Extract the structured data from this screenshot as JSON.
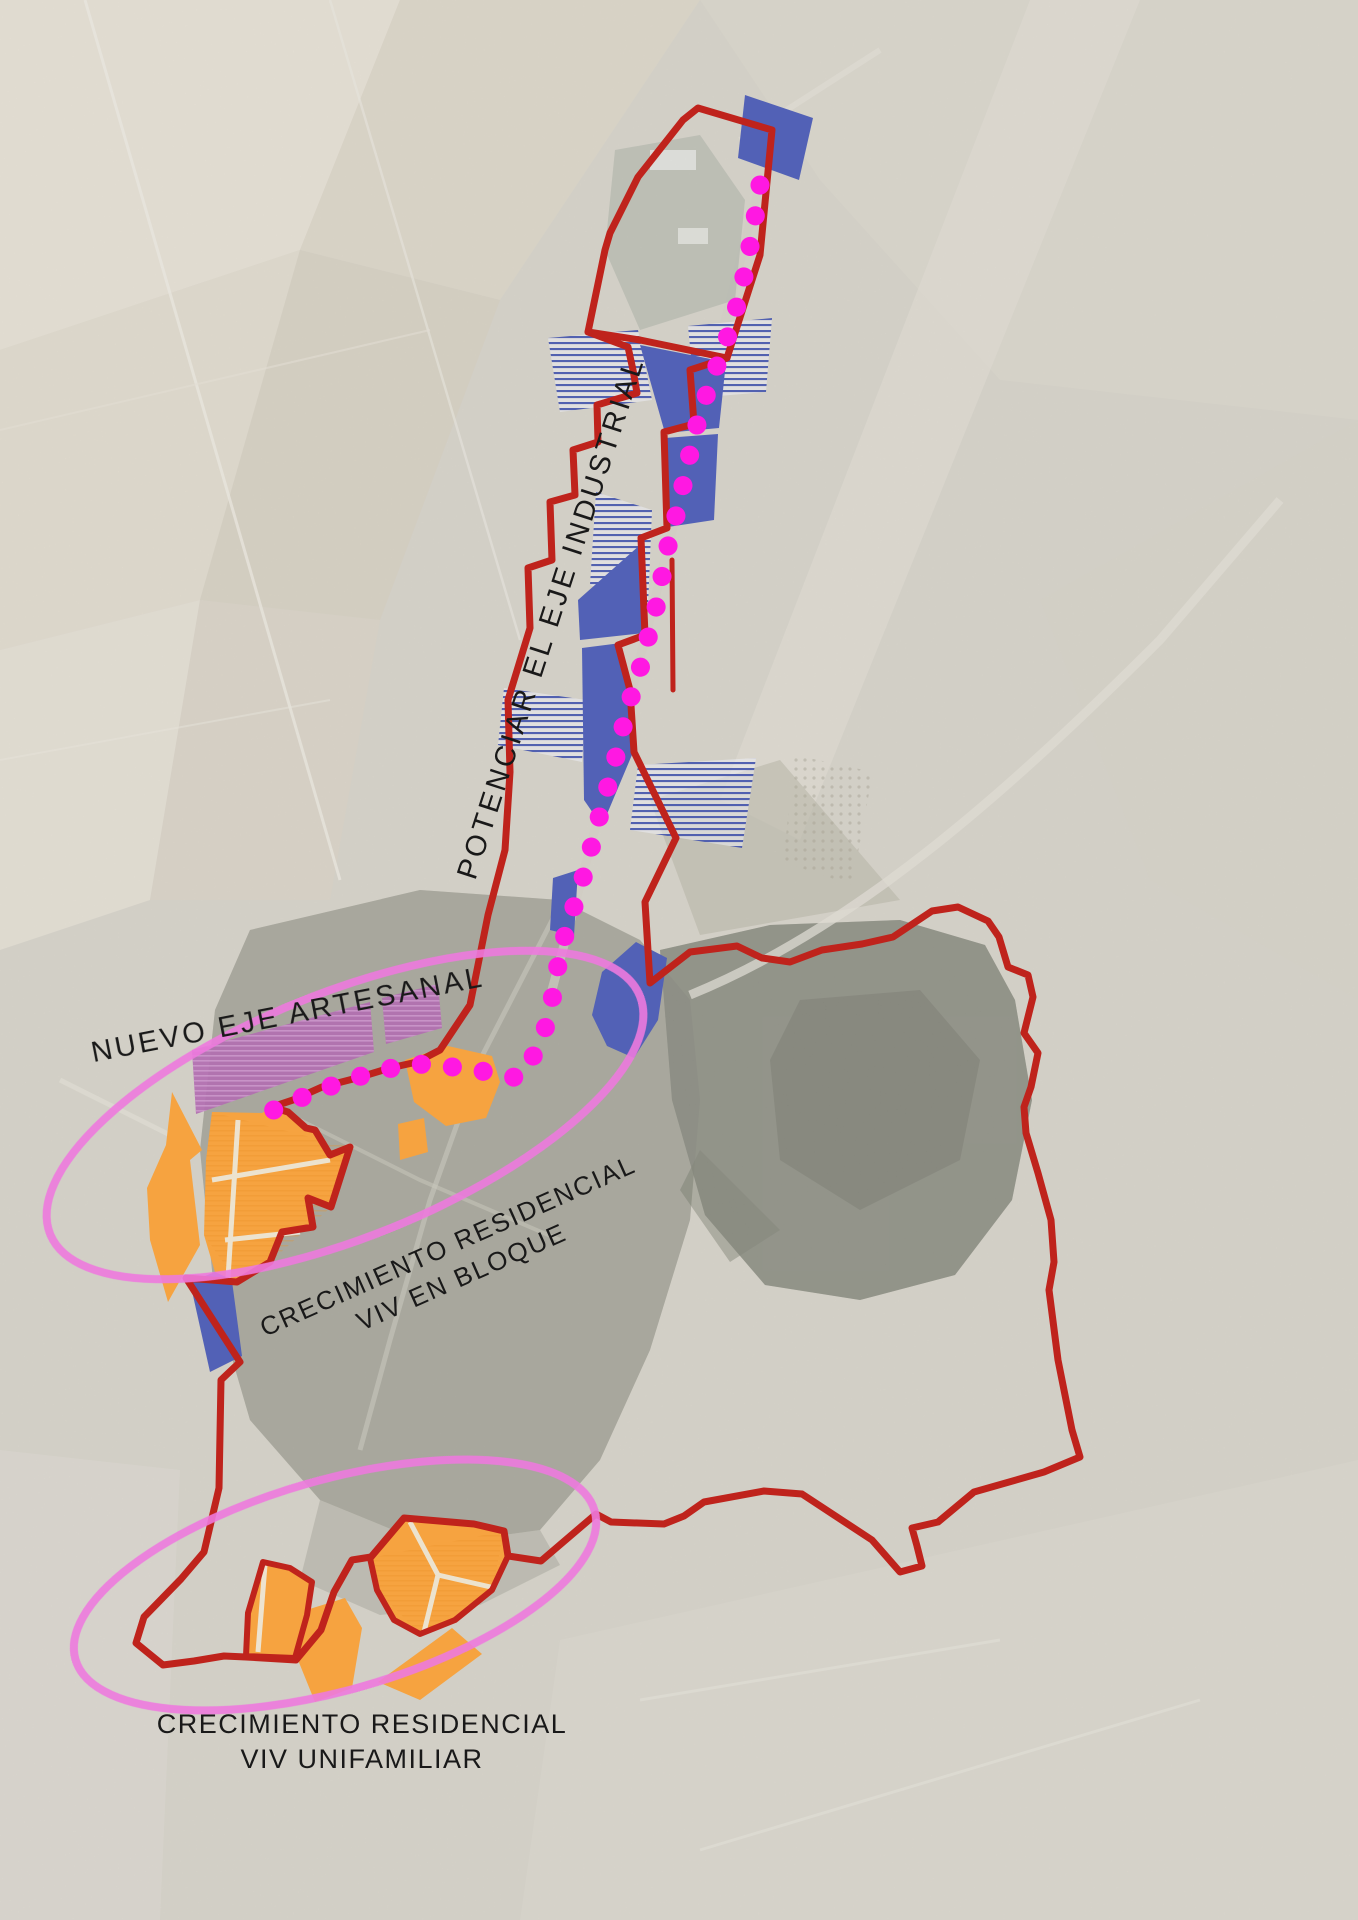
{
  "map": {
    "type": "urban-planning-strategy-map",
    "labels": {
      "industrial_axis": "POTENCIAR EL EJE INDUSTRIAL",
      "artisan_axis": "NUEVO EJE ARTESANAL",
      "residential_block": {
        "line1": "CRECIMIENTO RESIDENCIAL",
        "line2": "VIV EN BLOQUE"
      },
      "residential_detached": {
        "line1": "CRECIMIENTO RESIDENCIAL",
        "line2": "VIV UNIFAMILIAR"
      }
    },
    "colors": {
      "boundary_red": "#bf231c",
      "industrial_blue": "#5261b6",
      "industrial_hatch_blue": "#4353ac",
      "residential_orange": "#f6a340",
      "artisan_purple": "#b26fb1",
      "route_magenta": "#ff18e2",
      "ellipse_pink": "#ee7ade",
      "label_black": "#191919"
    }
  }
}
